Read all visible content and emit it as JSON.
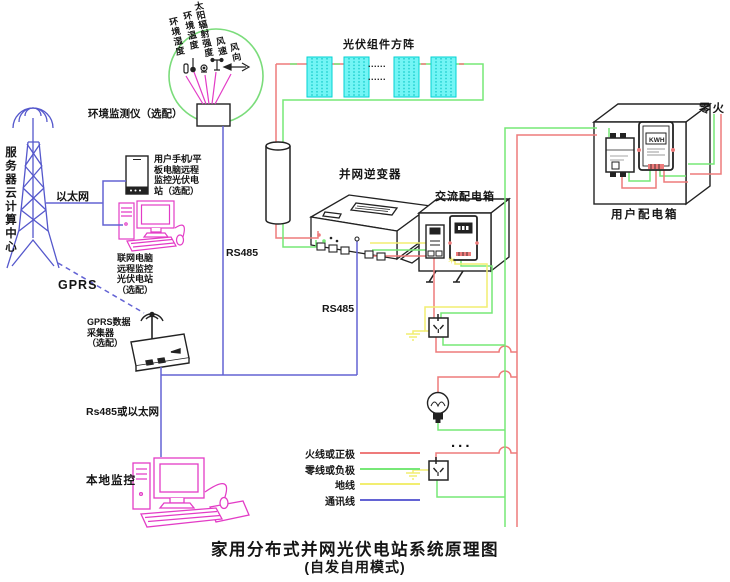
{
  "colors": {
    "live": "#ee7b7b",
    "neutral": "#77e877",
    "ground": "#f2ee71",
    "comm": "#6363d4",
    "magenta": "#e33cc6",
    "tower": "#5558cc",
    "panel": "#73f5f5",
    "panel_border": "#00d2d2",
    "circle": "#7bdc7b"
  },
  "title": {
    "main": "家用分布式并网光伏电站系统原理图",
    "sub": "(自发自用模式)"
  },
  "env_monitor": {
    "label": "环境监测仪（选配）",
    "sensor_labels": [
      "环境湿度",
      "环境温度",
      "太阳辐射强度",
      "风速",
      "风向"
    ]
  },
  "cloud_center": {
    "label": "服务器云计算中心"
  },
  "links": {
    "ethernet": "以太网",
    "gprs": "GPRS",
    "rs485_upper": "RS485",
    "rs485_lower": "RS485",
    "rs485_or_ethernet": "Rs485或以太网"
  },
  "remote": {
    "phone_label": "用户手机/平\n板电脑远程\n监控光伏电\n站（选配）",
    "pc_label": "联网电脑\n远程监控\n光伏电站\n（选配）",
    "collector_label": "GPRS数据\n采集器\n（选配）",
    "local_label": "本地监控"
  },
  "pv": {
    "array_label": "光伏组件方阵",
    "dots": "......"
  },
  "inverter": {
    "label": "并网逆变器"
  },
  "ac_box": {
    "label": "交流配电箱"
  },
  "user_box": {
    "label": "用户配电箱",
    "meter_display": "KWH",
    "mains_label": "零火"
  },
  "loads": {
    "dots": "..."
  },
  "legend": [
    {
      "label": "火线或正极",
      "color_key": "live"
    },
    {
      "label": "零线或负极",
      "color_key": "neutral"
    },
    {
      "label": "地线",
      "color_key": "ground"
    },
    {
      "label": "通讯线",
      "color_key": "comm"
    }
  ]
}
